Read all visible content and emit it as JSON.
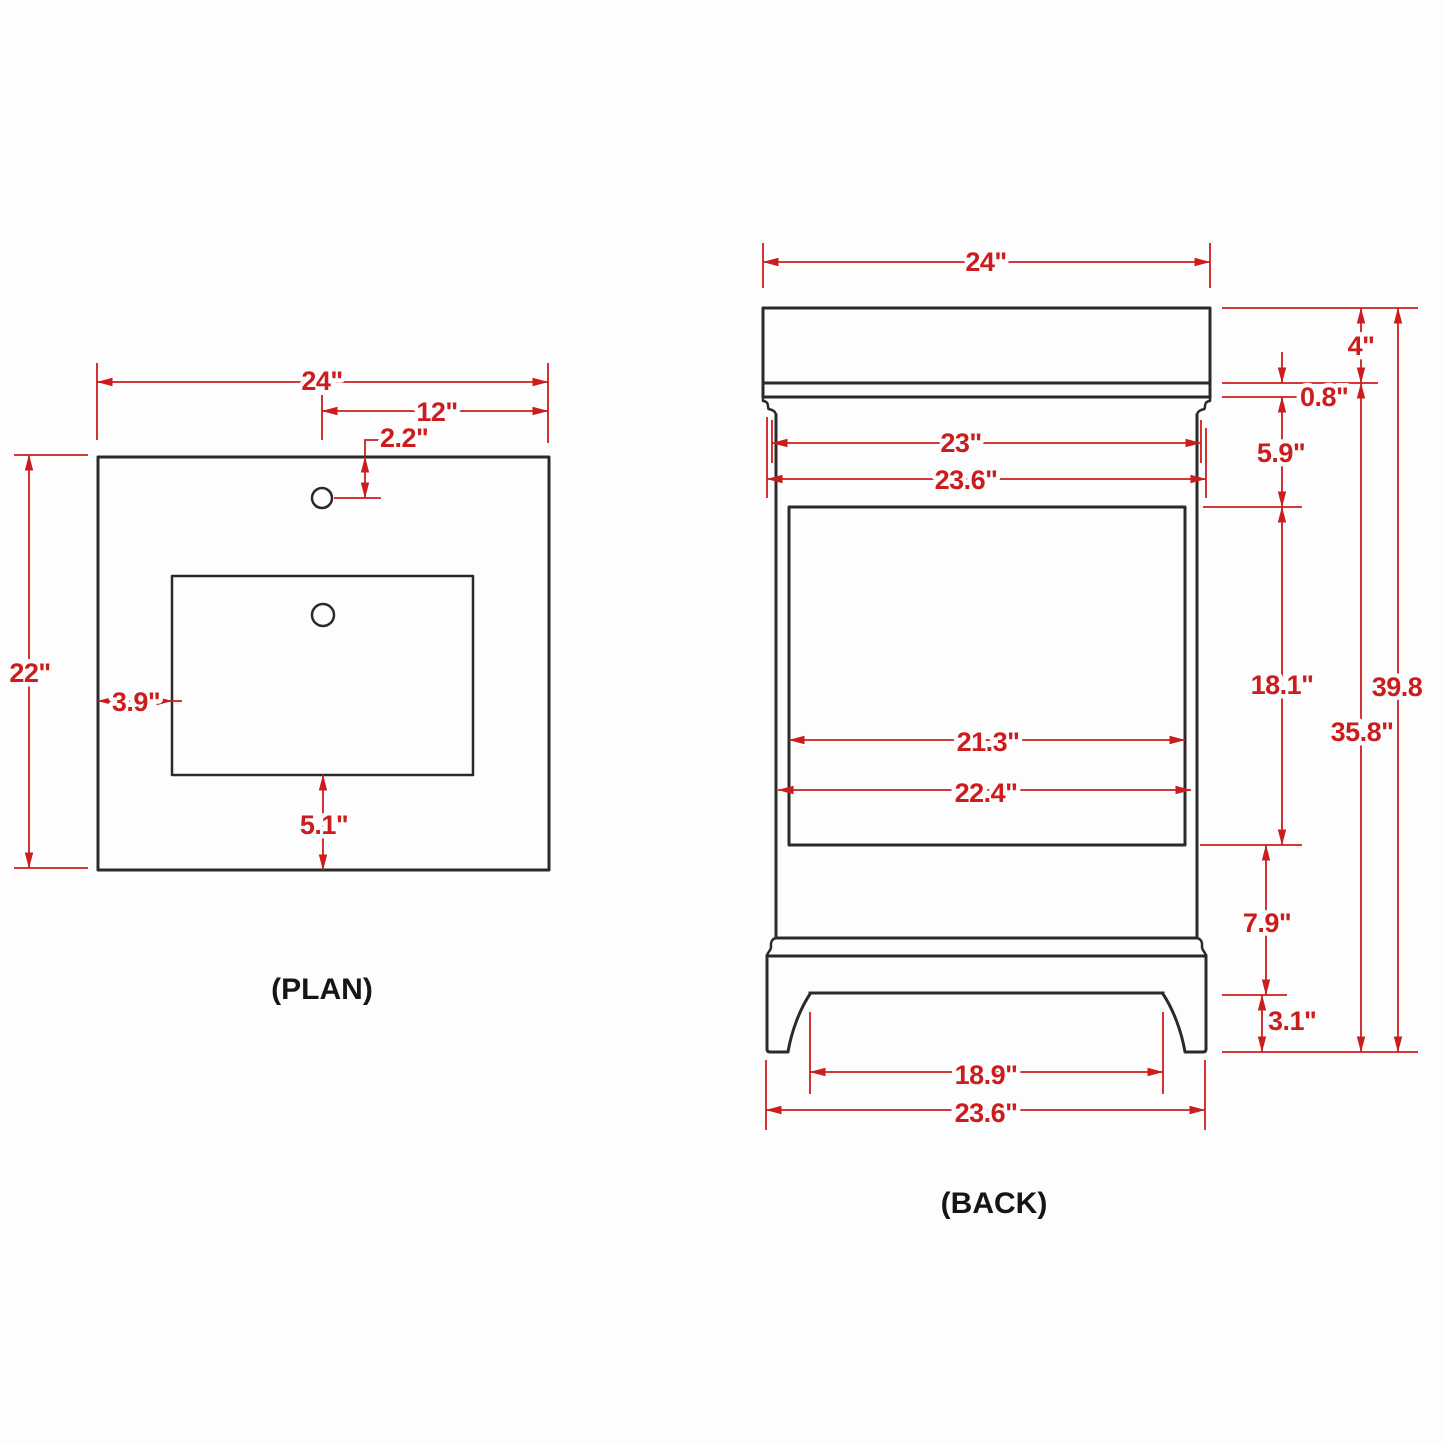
{
  "title": "Vanity dimension drawing",
  "colors": {
    "dimension_red": "#cb1d1d",
    "outline_black": "#2a2a2a",
    "background": "#fdfdfd"
  },
  "plan": {
    "label": "(PLAN)",
    "dims": {
      "overall_width": "24\"",
      "faucet_offset_from_center": "12\"",
      "faucet_setback": "2.2\"",
      "overall_depth": "22\"",
      "side_to_cutout": "3.9\"",
      "cutout_to_front": "5.1\""
    }
  },
  "back": {
    "label": "(BACK)",
    "dims": {
      "countertop_width": "24\"",
      "countertop_thickness": "4\"",
      "apron_height": "0.8\"",
      "top_to_panel": "5.9\"",
      "cabinet_width": "23\"",
      "cabinet_width_with_trim": "23.6\"",
      "panel_height": "18.1\"",
      "panel_width": "21.3\"",
      "interior_width": "22.4\"",
      "overall_height": "39.8",
      "cabinet_height": "35.8\"",
      "panel_to_base": "7.9\"",
      "base_height": "3.1\"",
      "feet_inner_span": "18.9\"",
      "base_width": "23.6\""
    }
  }
}
